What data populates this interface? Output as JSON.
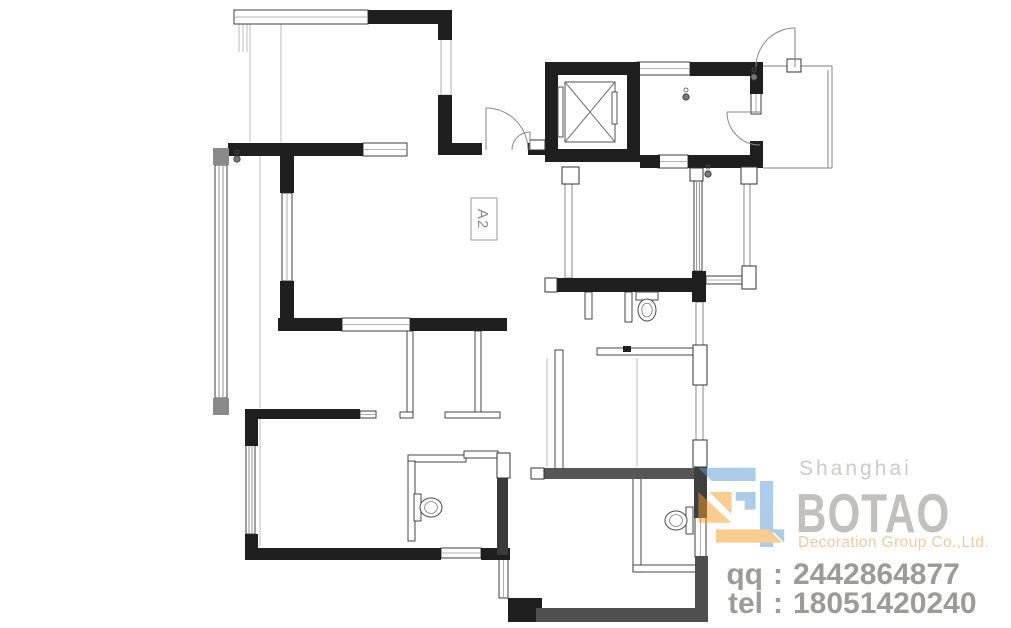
{
  "plan": {
    "a2": {
      "box": [
        471,
        198,
        26,
        42
      ],
      "label": "A2"
    },
    "wall_color": "#1f1f1f",
    "walls": [
      [
        368,
        10,
        84,
        14
      ],
      [
        438,
        10,
        14,
        30
      ],
      [
        438,
        95,
        14,
        60
      ],
      [
        228,
        143,
        135,
        13
      ],
      [
        280,
        155,
        14,
        38
      ],
      [
        280,
        281,
        14,
        50
      ],
      [
        278,
        318,
        64,
        13
      ],
      [
        410,
        318,
        97,
        13
      ],
      [
        245,
        409,
        13,
        37
      ],
      [
        248,
        409,
        112,
        10
      ],
      [
        245,
        534,
        13,
        26
      ],
      [
        245,
        548,
        196,
        12
      ],
      [
        481,
        548,
        29,
        12
      ],
      [
        450,
        143,
        32,
        12
      ],
      [
        528,
        143,
        17,
        12
      ],
      [
        545,
        62,
        95,
        13
      ],
      [
        545,
        62,
        13,
        100
      ],
      [
        627,
        62,
        13,
        100
      ],
      [
        545,
        149,
        95,
        13
      ],
      [
        690,
        62,
        73,
        14
      ],
      [
        750,
        62,
        13,
        32
      ],
      [
        750,
        141,
        13,
        26
      ],
      [
        640,
        155,
        20,
        13
      ],
      [
        688,
        155,
        75,
        13
      ],
      [
        557,
        278,
        138,
        14
      ],
      [
        692,
        271,
        14,
        31
      ],
      [
        497,
        478,
        11,
        77,
        "#3a3a3a"
      ],
      [
        508,
        598,
        34,
        24
      ],
      [
        536,
        608,
        172,
        14,
        "#4f4f4f"
      ],
      [
        695,
        556,
        13,
        66,
        "#4f4f4f"
      ],
      [
        544,
        468,
        150,
        11,
        "#565656"
      ],
      [
        694,
        466,
        13,
        52,
        "#3f3f3f"
      ],
      [
        623,
        346,
        8,
        6
      ],
      [
        213,
        148,
        16,
        17,
        "#8a8a8a"
      ],
      [
        213,
        398,
        16,
        17,
        "#8a8a8a"
      ]
    ],
    "windows": [
      [
        234,
        10,
        134,
        14,
        "h"
      ],
      [
        363,
        143,
        44,
        13,
        "h"
      ],
      [
        342,
        318,
        68,
        13,
        "h"
      ],
      [
        360,
        411,
        16,
        7,
        "h"
      ],
      [
        441,
        38,
        10,
        57,
        "plain"
      ],
      [
        282,
        193,
        10,
        88,
        "v"
      ],
      [
        215,
        165,
        12,
        233,
        "v4"
      ],
      [
        246,
        445,
        9,
        89,
        "v4"
      ],
      [
        441,
        548,
        40,
        10,
        "h"
      ],
      [
        499,
        555,
        9,
        43,
        "v"
      ],
      [
        695,
        517,
        11,
        40,
        "v"
      ],
      [
        637,
        62,
        53,
        13,
        "h"
      ],
      [
        658,
        155,
        30,
        13,
        "h"
      ],
      [
        751,
        92,
        10,
        22,
        "v"
      ],
      [
        694,
        181,
        8,
        90,
        "v4"
      ],
      [
        744,
        181,
        6,
        86,
        "v2"
      ],
      [
        706,
        276,
        37,
        8,
        "h"
      ],
      [
        696,
        302,
        7,
        43,
        "v2"
      ],
      [
        696,
        385,
        7,
        55,
        "v2"
      ],
      [
        565,
        184,
        7,
        94,
        "v2"
      ]
    ],
    "thin_walls": [
      [
        407,
        331,
        6,
        84
      ],
      [
        475,
        331,
        6,
        82
      ],
      [
        445,
        412,
        55,
        6
      ],
      [
        400,
        412,
        13,
        6
      ],
      [
        408,
        455,
        58,
        7
      ],
      [
        464,
        451,
        34,
        7
      ],
      [
        408,
        461,
        7,
        80
      ],
      [
        555,
        350,
        8,
        127
      ],
      [
        597,
        348,
        100,
        7
      ],
      [
        633,
        478,
        8,
        94
      ],
      [
        633,
        565,
        74,
        7
      ],
      [
        585,
        292,
        7,
        27
      ],
      [
        625,
        292,
        7,
        30
      ]
    ],
    "columns": [
      [
        690,
        168,
        13,
        13
      ],
      [
        741,
        167,
        16,
        17
      ],
      [
        742,
        266,
        14,
        23
      ],
      [
        693,
        345,
        14,
        40
      ],
      [
        693,
        440,
        14,
        27
      ],
      [
        562,
        167,
        17,
        17
      ],
      [
        530,
        140,
        15,
        10
      ],
      [
        497,
        453,
        13,
        25
      ],
      [
        531,
        468,
        13,
        11
      ],
      [
        545,
        278,
        12,
        14
      ],
      [
        787,
        59,
        14,
        13
      ]
    ],
    "guide_lines": [
      [
        250,
        24,
        250,
        142
      ],
      [
        281,
        24,
        281,
        142
      ],
      [
        260,
        156,
        260,
        408
      ],
      [
        260,
        419,
        260,
        547
      ],
      [
        547,
        358,
        547,
        467
      ],
      [
        637,
        358,
        637,
        467
      ],
      [
        239,
        24,
        239,
        52
      ],
      [
        243,
        24,
        243,
        52
      ],
      [
        247,
        24,
        247,
        52
      ]
    ],
    "landing_lines": [
      [
        763,
        66,
        832,
        66
      ],
      [
        832,
        66,
        832,
        168
      ],
      [
        828,
        70,
        828,
        168
      ],
      [
        763,
        168,
        832,
        168
      ]
    ],
    "doors": [
      {
        "leaf": [
          486,
          108,
          486,
          150
        ],
        "arc": "M 486,108 A 42 42 0 0 1 528,150"
      },
      {
        "leaf": [
          530,
          132,
          530,
          150
        ],
        "arc": "M 512,150 A 18 18 0 0 1 530,132"
      },
      {
        "leaf": [
          795,
          28,
          795,
          67
        ],
        "arc": "M 756,67 A 39 39 0 0 1 795,28"
      },
      {
        "leaf": [
          727,
          112,
          760,
          112
        ],
        "arc": "M 727,112 A 33 33 0 0 0 760,145"
      }
    ],
    "elevator": {
      "car": [
        565,
        82,
        50,
        60
      ],
      "rails": [
        [
          558,
          87,
          5,
          50
        ],
        [
          612,
          92,
          5,
          32
        ]
      ]
    },
    "toilets": [
      {
        "tank": [
          636,
          292,
          22,
          8
        ],
        "dir": "down"
      },
      {
        "tank": [
          414,
          494,
          7,
          27
        ],
        "dir": "right"
      },
      {
        "tank": [
          686,
          507,
          7,
          27
        ],
        "dir": "left"
      }
    ],
    "lamps": [
      [
        237,
        152
      ],
      [
        686,
        90
      ],
      [
        708,
        167
      ],
      [
        754,
        70
      ]
    ]
  },
  "watermark": {
    "location": "Shanghai",
    "brand": "BOTAO",
    "subtitle": "Decoration Group Co.,Ltd.",
    "qq_label": "qq",
    "qq_value": "2442864877",
    "tel_label": "tel",
    "tel_value": "18051420240",
    "colon": ":",
    "colors": {
      "blue": "#5b9bd5",
      "orange": "#f59a23"
    },
    "logo": {
      "x": 694,
      "y": 459,
      "scale": 1.1,
      "polys": [
        {
          "p": "4,8 56,8 56,20 16,20",
          "c": "blue"
        },
        {
          "p": "60,20 72,20 72,80 60,80",
          "c": "blue"
        },
        {
          "p": "38,30 56,30 56,46 46,46 46,38 38,38",
          "c": "blue"
        },
        {
          "p": "70,64 82,76 82,64",
          "c": "blue"
        },
        {
          "p": "4,30 34,58 4,58",
          "c": "orange"
        },
        {
          "p": "14,30 34,30 34,50",
          "c": "orange"
        },
        {
          "p": "20,64 68,64 80,76 20,76",
          "c": "orange"
        }
      ]
    }
  }
}
